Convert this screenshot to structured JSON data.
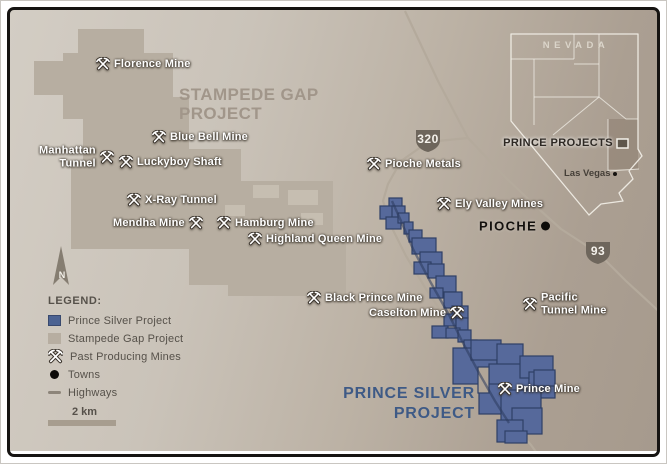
{
  "title": "Prince Silver Project location map",
  "region_labels": {
    "stampede": {
      "line1": "STAMPEDE GAP",
      "line2": "PROJECT"
    },
    "prince": {
      "line1": "PRINCE SILVER",
      "line2": "PROJECT"
    }
  },
  "map": {
    "north_label": "N",
    "mines": [
      {
        "name": "Florence Mine",
        "x": 95,
        "y": 63,
        "icon": "left"
      },
      {
        "name": "Blue Bell Mine",
        "x": 151,
        "y": 136,
        "icon": "left"
      },
      {
        "name": "Manhattan\nTunnel",
        "x": 38,
        "y": 156,
        "icon": "right",
        "align": "right"
      },
      {
        "name": "Luckyboy Shaft",
        "x": 118,
        "y": 161,
        "icon": "left"
      },
      {
        "name": "X-Ray Tunnel",
        "x": 126,
        "y": 199,
        "icon": "left"
      },
      {
        "name": "Mendha Mine",
        "x": 112,
        "y": 222,
        "icon": "right"
      },
      {
        "name": "Hamburg Mine",
        "x": 216,
        "y": 222,
        "icon": "left"
      },
      {
        "name": "Highland Queen Mine",
        "x": 247,
        "y": 238,
        "icon": "left"
      },
      {
        "name": "Pioche Metals",
        "x": 366,
        "y": 163,
        "icon": "left"
      },
      {
        "name": "Ely Valley Mines",
        "x": 436,
        "y": 203,
        "icon": "left"
      },
      {
        "name": "Black Prince Mine",
        "x": 306,
        "y": 297,
        "icon": "left"
      },
      {
        "name": "Caselton Mine",
        "x": 368,
        "y": 312,
        "icon": "right"
      },
      {
        "name": "Pacific\nTunnel Mine",
        "x": 522,
        "y": 303,
        "icon": "left"
      },
      {
        "name": "Prince Mine",
        "x": 497,
        "y": 388,
        "icon": "left"
      }
    ],
    "towns": [
      {
        "name": "PIOCHE",
        "x": 478,
        "y": 225
      }
    ],
    "highway_shields": [
      {
        "number": "320",
        "x": 427,
        "y": 140
      },
      {
        "number": "93",
        "x": 597,
        "y": 252
      }
    ]
  },
  "inset": {
    "state_label": "NEVADA",
    "project_label": "PRINCE PROJECTS",
    "city_label": "Las Vegas"
  },
  "legend": {
    "title": "LEGEND:",
    "items": [
      {
        "label": "Prince Silver Project",
        "swatch": "blue-square"
      },
      {
        "label": "Stampede Gap Project",
        "swatch": "tan-square"
      },
      {
        "label": "Past Producing Mines",
        "swatch": "picks"
      },
      {
        "label": "Towns",
        "swatch": "dot"
      },
      {
        "label": "Highways",
        "swatch": "line"
      }
    ],
    "scale_label": "2 km"
  },
  "colors": {
    "map_background_light": "#cac3b9",
    "map_background_dark": "#a69a8d",
    "prince_silver_fill": "#56699b",
    "prince_silver_border": "#2f3f66",
    "stampede_gap_fill": "#b7aea1",
    "road": "#b4aa9c",
    "shield_fill": "#6e665c",
    "prince_text": "#3e5a86",
    "stampede_text": "#a1968a",
    "frame": "#161412"
  }
}
